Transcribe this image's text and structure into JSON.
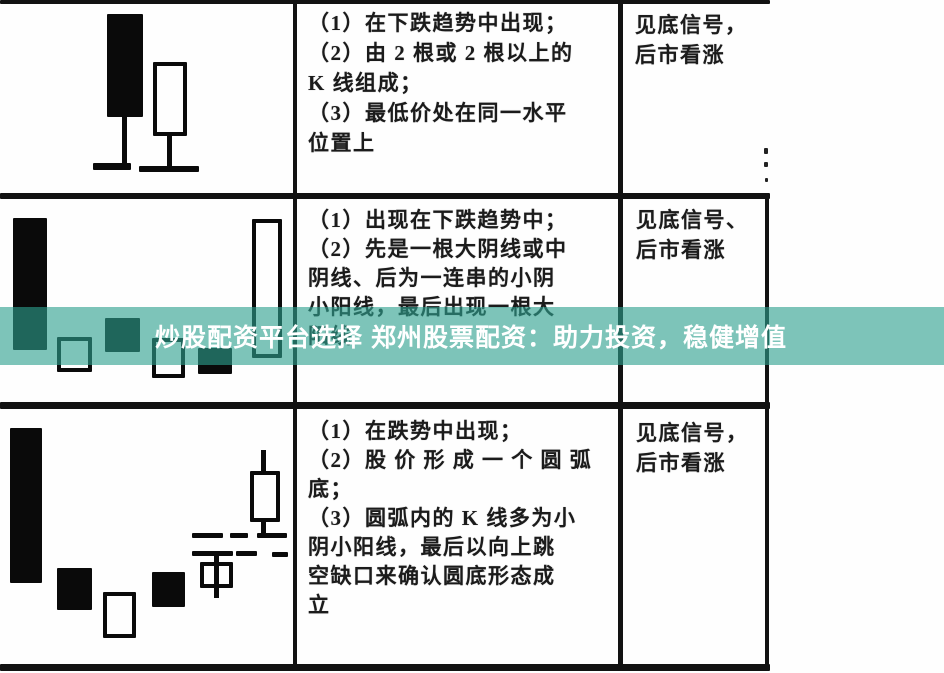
{
  "banner": {
    "text": "炒股配资平台选择 郑州股票配资：助力投资，稳健增值",
    "bg_rgba": "rgba(45,160,142,0.62)",
    "text_color": "#ffffff"
  },
  "table": {
    "rows": [
      {
        "description_lines": [
          "（1）在下跌趋势中出现；",
          "（2）由 2 根或 2 根以上的",
          "K 线组成；",
          "（3）最低价处在同一水平",
          "位置上"
        ],
        "signal_lines": [
          "见底信号，",
          "后市看涨"
        ]
      },
      {
        "description_lines": [
          "（1）出现在下跌趋势中；",
          "（2）先是一根大阴线或中",
          "阴线、后为一连串的小阴",
          "小阳线，最后出现一根大",
          "阳线"
        ],
        "signal_lines": [
          "见底信号、",
          "后市看涨"
        ]
      },
      {
        "description_lines": [
          "（1）在跌势中出现；",
          "（2）股 价 形 成 一 个 圆 弧",
          "底；",
          "（3）圆弧内的 K 线多为小",
          "阴小阳线，最后以向上跳",
          "空缺口来确认圆底形态成",
          "立"
        ],
        "signal_lines": [
          "见底信号，",
          "后市看涨"
        ]
      }
    ]
  }
}
